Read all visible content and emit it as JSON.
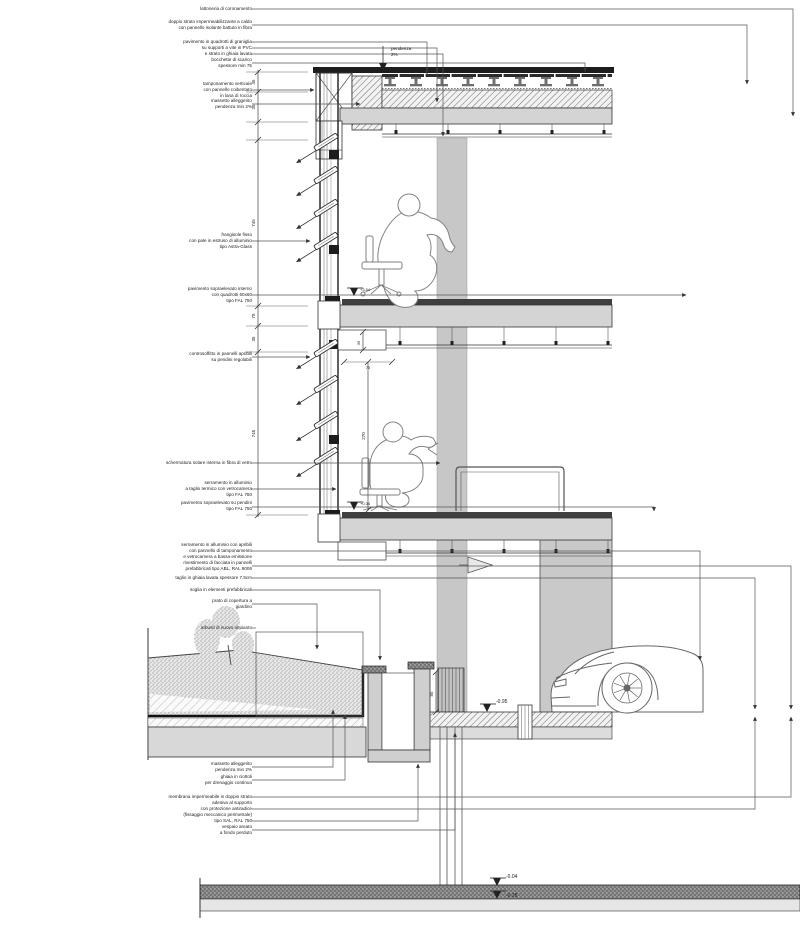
{
  "drawing": {
    "title": "sezione costruttiva di facciata",
    "type": "architectural-section-detail",
    "colors": {
      "line": "#333333",
      "slab_fill": "#d4d4d4",
      "column_fill": "#c7c7c7",
      "wall_fill": "#c9c9c9",
      "dark_band": "#8f8f8f"
    },
    "slope_note": {
      "line1": "pendenza",
      "line2": "2%"
    },
    "annotations": [
      {
        "lines": [
          "lattoneria di coronamento"
        ]
      },
      {
        "lines": [
          "doppio strato impermeabilizzante a caldo",
          "con pannello isolante battuto in fibra"
        ]
      },
      {
        "lines": [
          "pavimento in quadrotti di graniglia",
          "su supporti a vite in PVC",
          "e strato in ghiaia lavata"
        ]
      },
      {
        "lines": [
          "bocchette di scarico",
          "spessore min 75"
        ]
      },
      {
        "lines": [
          "tamponamento verticale",
          "con pannello coibentato",
          "in lana di roccia"
        ]
      },
      {
        "lines": [
          "massetto alleggerito",
          "pendenza min 2%"
        ]
      },
      {
        "lines": [
          "frangisole fisso",
          "con pale in estruso di alluminio",
          "tipo Astra-Glass"
        ]
      },
      {
        "lines": [
          "pavimento sopraelevato interno",
          "con quadrotti 60x60",
          "tipo FAL 750"
        ]
      },
      {
        "lines": [
          "controsoffitto in pannelli apribili",
          "su pendini regolabili"
        ]
      },
      {
        "lines": [
          "schermatura solare interna in fibra di vetro"
        ]
      },
      {
        "lines": [
          "serramento in alluminio",
          "a taglio termico con vetrocamera",
          "tipo FAL 750"
        ]
      },
      {
        "lines": [
          "pavimento sopraelevato su pendini",
          "tipo FAL 750"
        ]
      },
      {
        "lines": [
          "serramento in alluminio con apribili",
          "con pannello di tamponamento",
          "e vetrocamera a bassa emissione"
        ]
      },
      {
        "lines": [
          "rivestimento di facciata in pannelli",
          "prefabbricati tipo ABL, RAL 9006"
        ]
      },
      {
        "lines": [
          "taglio in ghiaia lavata spessore 7.5cm"
        ]
      },
      {
        "lines": [
          "soglia in elementi prefabbricati"
        ]
      },
      {
        "lines": [
          "prato di copertura a",
          "giardino"
        ]
      },
      {
        "lines": [
          "arbusti di nuovo impianto"
        ]
      },
      {
        "lines": [
          "massetto alleggerito",
          "pendenza min 2%"
        ]
      },
      {
        "lines": [
          "ghiaia in ciottoli",
          "per drenaggio continuo"
        ]
      },
      {
        "lines": [
          "membrana impermeabile in doppio strato",
          "adesiva al supporto",
          "con protezione antiradice",
          "(fissaggio meccanico perimetrale)",
          "tipo SAL, RAL 750"
        ]
      },
      {
        "lines": [
          "vespaio areato",
          "a fondo perduto"
        ]
      }
    ],
    "dimensions": {
      "chain": [
        "45",
        "35",
        "745",
        "75",
        "35",
        "745"
      ],
      "room_height": "270",
      "bulkhead_height": "35",
      "sill_depth": "75",
      "channel_height": "85"
    },
    "levels": [
      {
        "name": "garage-floor",
        "value": "-0.95"
      },
      {
        "name": "foundation-top",
        "value": "-0.04"
      },
      {
        "name": "foundation-bottom",
        "value": "-0.28"
      },
      {
        "name": "floor-two",
        "value": "+3.54"
      },
      {
        "name": "floor-three",
        "value": "+0.34"
      }
    ]
  }
}
